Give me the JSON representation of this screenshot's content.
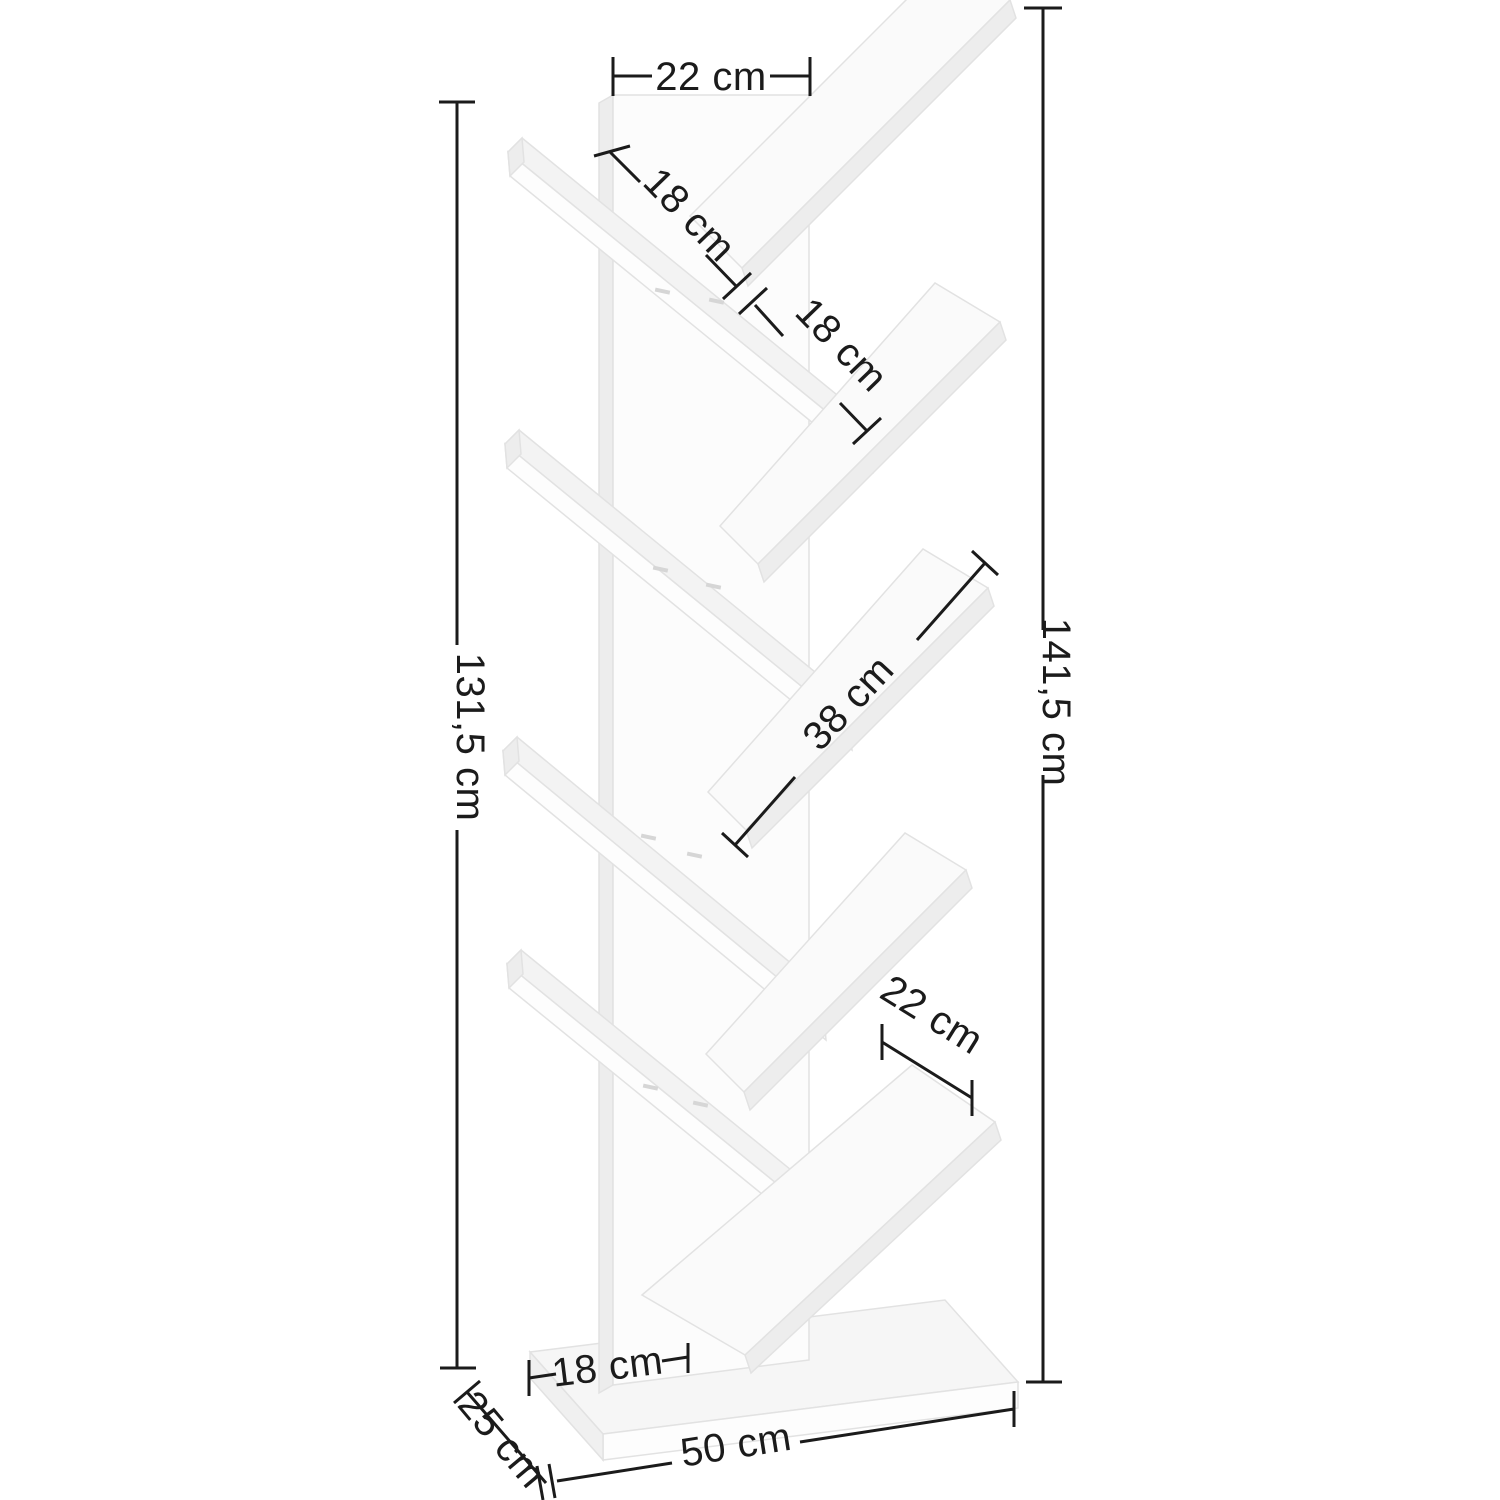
{
  "diagram": {
    "subject": "tree-bookshelf-dimension-diagram",
    "unit": "cm",
    "line_color": "#1b1b1b",
    "board_color": "#fafafa",
    "labels": {
      "top_width": "22 cm",
      "upper_shelf_a": "18 cm",
      "upper_shelf_b": "18 cm",
      "middle_shelf": "38 cm",
      "height_right": "141,5 cm",
      "height_left": "131,5 cm",
      "lower_shelf_depth": "22 cm",
      "base_offset": "18 cm",
      "base_depth": "25 cm",
      "base_width": "50 cm"
    }
  }
}
